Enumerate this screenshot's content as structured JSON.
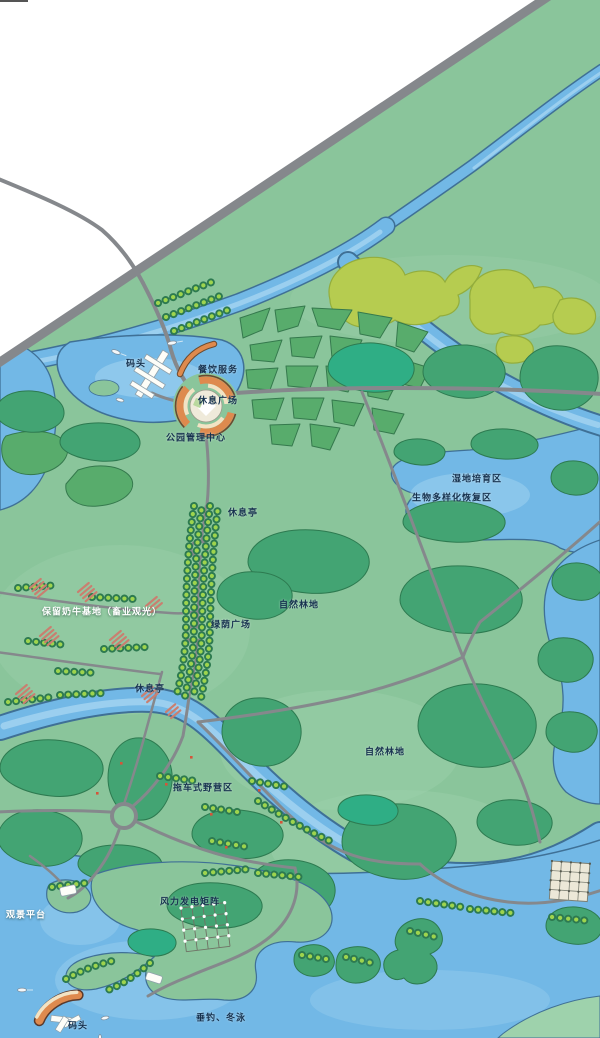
{
  "map": {
    "labels": [
      {
        "text": "码头",
        "x": 136,
        "y": 365,
        "tone": "dark"
      },
      {
        "text": "餐饮服务",
        "x": 218,
        "y": 371,
        "tone": "dark"
      },
      {
        "text": "休息广场",
        "x": 218,
        "y": 402,
        "tone": "dark"
      },
      {
        "text": "公园管理中心",
        "x": 196,
        "y": 439,
        "tone": "dark"
      },
      {
        "text": "湿地培育区",
        "x": 477,
        "y": 480,
        "tone": "dark"
      },
      {
        "text": "生物多样化恢复区",
        "x": 452,
        "y": 499,
        "tone": "dark"
      },
      {
        "text": "休息亭",
        "x": 243,
        "y": 514,
        "tone": "dark"
      },
      {
        "text": "自然林地",
        "x": 299,
        "y": 606,
        "tone": "dark"
      },
      {
        "text": "绿荫广场",
        "x": 231,
        "y": 626,
        "tone": "dark"
      },
      {
        "text": "保留奶牛基地（畜业观光）",
        "x": 102,
        "y": 613,
        "tone": "light"
      },
      {
        "text": "休息亭",
        "x": 150,
        "y": 690,
        "tone": "dark"
      },
      {
        "text": "拖车式野营区",
        "x": 203,
        "y": 789,
        "tone": "dark"
      },
      {
        "text": "自然林地",
        "x": 385,
        "y": 753,
        "tone": "dark"
      },
      {
        "text": "风力发电矩阵",
        "x": 190,
        "y": 903,
        "tone": "dark"
      },
      {
        "text": "观景平台",
        "x": 26,
        "y": 916,
        "tone": "light"
      },
      {
        "text": "码头",
        "x": 78,
        "y": 1027,
        "tone": "dark"
      },
      {
        "text": "垂钓、冬泳",
        "x": 221,
        "y": 1019,
        "tone": "dark"
      }
    ]
  },
  "colors": {
    "land": "#8ac59b",
    "landLight": "#9ed2ac",
    "water": "#72b8e6",
    "waterEdge": "#3f7096",
    "waterLight": "#a9d7f2",
    "forest": "#43a473",
    "forestDark": "#2d7a50",
    "forestTeal": "#2fae85",
    "hedge": "#58ac6c",
    "hedgeEdge": "#35794d",
    "olive": "#b6cc50",
    "oliveEdge": "#93ad3c",
    "road": "#85888c",
    "treeDot": "#9ed44e",
    "plazaOrange": "#de8a4e",
    "plazaCream": "#f2e3c4",
    "plazaRim": "#6b4a2f",
    "building": "#c97f70",
    "labelDark": "#16324f",
    "labelLight": "#ffffff"
  }
}
